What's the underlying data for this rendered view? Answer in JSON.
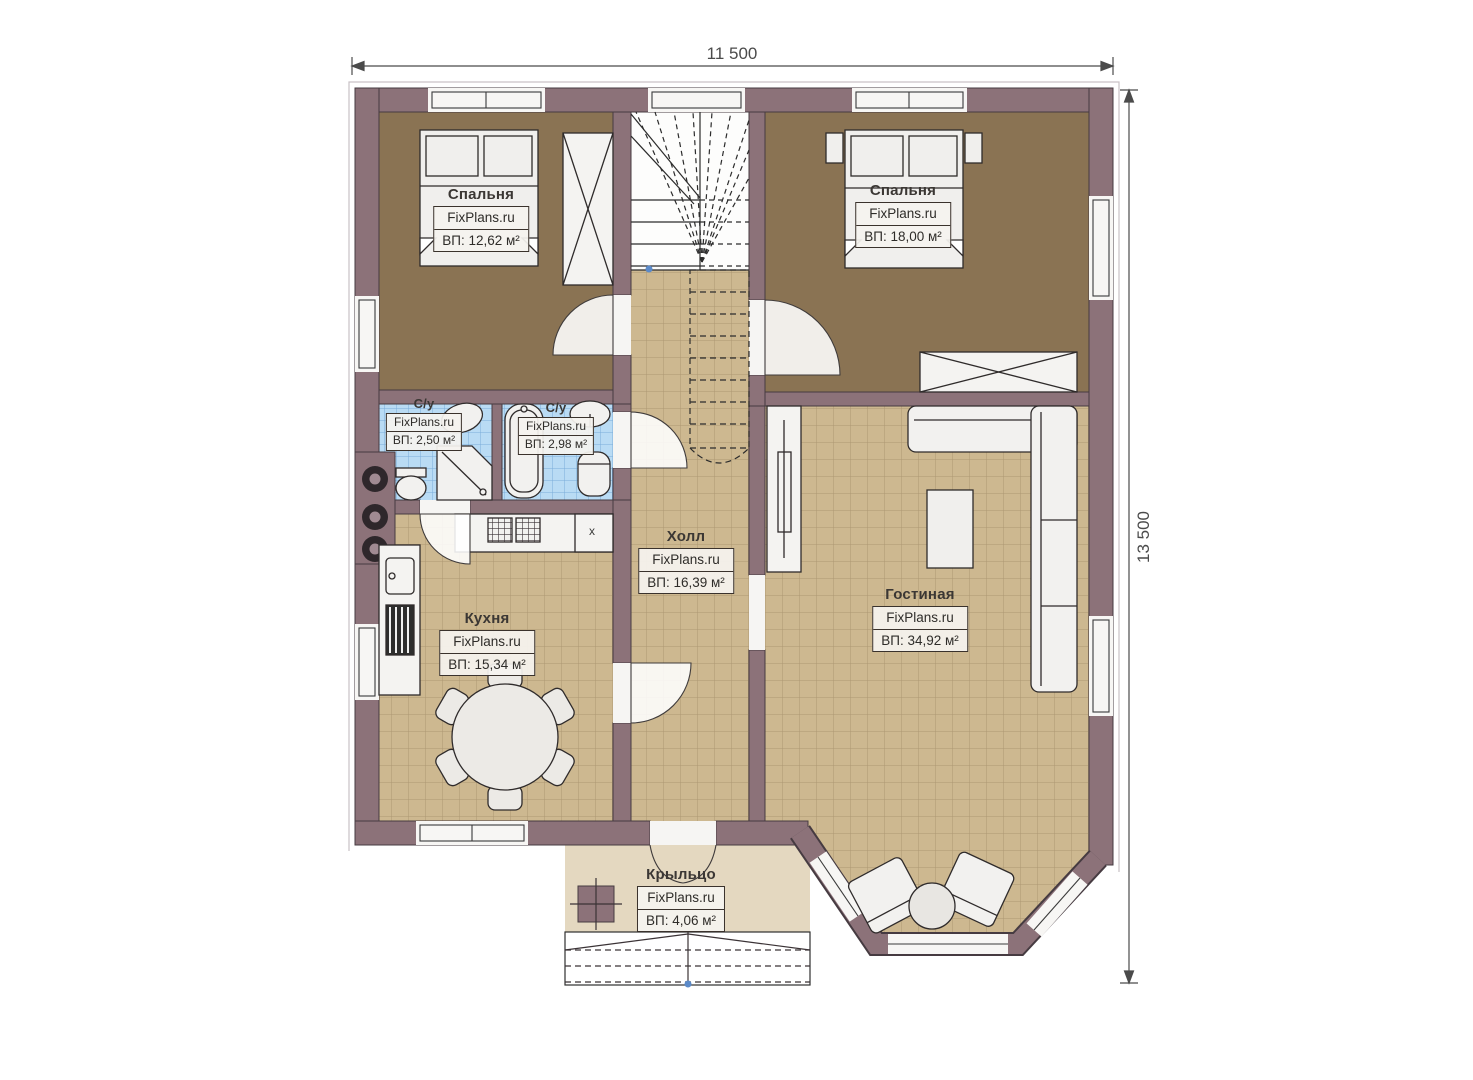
{
  "dimensions": {
    "top": "11 500",
    "right": "13 500"
  },
  "watermark": "FixPlans.ru",
  "rooms": [
    {
      "name": "Спальня",
      "area": "ВП: 12,62 м²"
    },
    {
      "name": "Спальня",
      "area": "ВП: 18,00 м²"
    },
    {
      "name": "С/у",
      "area": "ВП: 2,50 м²"
    },
    {
      "name": "С/у",
      "area": "ВП: 2,98 м²"
    },
    {
      "name": "Холл",
      "area": "ВП: 16,39 м²"
    },
    {
      "name": "Кухня",
      "area": "ВП: 15,34 м²"
    },
    {
      "name": "Гостиная",
      "area": "ВП: 34,92 м²"
    },
    {
      "name": "Крыльцо",
      "area": "ВП: 4,06 м²"
    }
  ],
  "misc": {
    "cabinet_mark": "x"
  },
  "colors": {
    "wall": "#8c7279",
    "outline": "#463b41",
    "floor_bedroom": "#8a7353",
    "floor_tile_tan": "#cdb890",
    "floor_tile_blue": "#b9dbf4",
    "floor_porch": "#e4d8c0"
  }
}
